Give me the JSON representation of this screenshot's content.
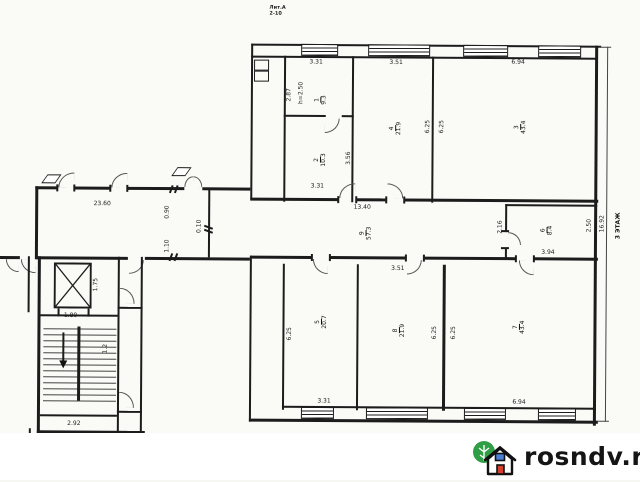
{
  "watermark": {
    "brand": "rosndv.ru",
    "tree_color": "#2f9e44",
    "window_color": "#4a7fd4",
    "door_color": "#d6402e"
  },
  "stamp": {
    "line1": "Лит.А",
    "line2": "2-10"
  },
  "side": {
    "height_dim": "16.92",
    "floor_label": "3 ЭТАЖ"
  },
  "corridor": {
    "number": "9",
    "area": "57.3",
    "dim_left": "23.60",
    "dim_right": "13.40"
  },
  "rooms": {
    "r1": {
      "number": "1",
      "area": "9.3",
      "note": "h=2.50",
      "dim_top": "3.31",
      "dim_left": "2.87"
    },
    "r2": {
      "number": "2",
      "area": "10.3",
      "dim_right": "3.56",
      "dim_bottom": "3.31"
    },
    "r4": {
      "number": "4",
      "area": "21.9",
      "dim_top": "3.51",
      "dim_right": "6.25"
    },
    "r3": {
      "number": "3",
      "area": "43.4",
      "dim_top": "6.94",
      "dim_left": "6.25"
    },
    "r6": {
      "number": "6",
      "area": "8.4",
      "dim_left": "2.16",
      "dim_right": "2.50",
      "dim_bottom": "3.94"
    },
    "r5": {
      "number": "5",
      "area": "20.7",
      "dim_left": "6.25",
      "dim_bottom": "3.31"
    },
    "r8": {
      "number": "8",
      "area": "21.9",
      "dim_top": "3.51",
      "dim_right": "6.25"
    },
    "r7": {
      "number": "7",
      "area": "43.4",
      "dim_left": "6.25",
      "dim_bottom": "6.94"
    }
  },
  "stairwell": {
    "elevator_width": "1.80",
    "elevator_depth": "1.75",
    "flight_mark": "1.2",
    "width": "2.92"
  },
  "wall_marks": {
    "m1": "0.90",
    "m2": "0.10",
    "m3": "1.10"
  }
}
